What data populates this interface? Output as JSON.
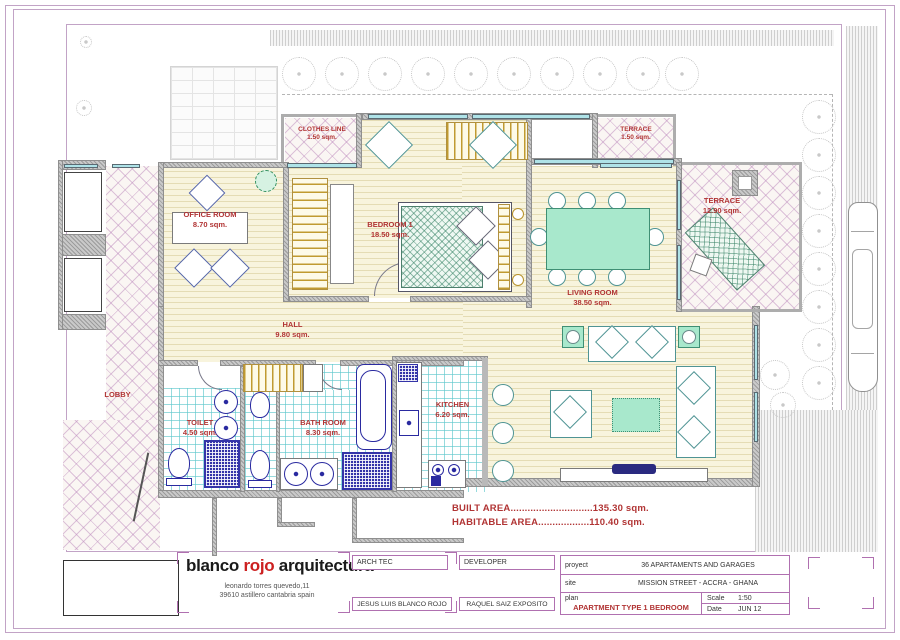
{
  "colors": {
    "accent_red": "#b13434",
    "frame_purple": "#c2a3c6",
    "table_purple": "#b070b0",
    "window_cyan": "#afe3e8",
    "furniture_teal": "#4f9494",
    "fixture_blue": "#2a2aa0",
    "floor_ivory": "#f8f4dd",
    "logo_red": "#cc2020"
  },
  "plan": {
    "rooms": {
      "office": {
        "name": "OFFICE ROOM",
        "area": "8.70 sqm."
      },
      "clothes_line": {
        "name": "CLOTHES LINE",
        "area": "1.50 sqm."
      },
      "bedroom1": {
        "name": "BEDROOM 1",
        "area": "18.50 sqm."
      },
      "terrace_small": {
        "name": "TERRACE",
        "area": "1.50 sqm."
      },
      "terrace_big": {
        "name": "TERRACE",
        "area": "12.90 sqm."
      },
      "living": {
        "name": "LIVING ROOM",
        "area": "38.50 sqm."
      },
      "hall": {
        "name": "HALL",
        "area": "9.80 sqm."
      },
      "lobby": {
        "name": "LOBBY",
        "area": ""
      },
      "toilet": {
        "name": "TOILET",
        "area": "4.50 sqm."
      },
      "bathroom": {
        "name": "BATH ROOM",
        "area": "8.30 sqm."
      },
      "kitchen": {
        "name": "KITCHEN",
        "area": "6.20 sqm."
      }
    },
    "summary": {
      "built_area": "BUILT AREA.............................135.30 sqm.",
      "habitable_area": "HABITABLE AREA..................110.40 sqm."
    }
  },
  "titleblock": {
    "firm_blanco": "blanco",
    "firm_rojo": "rojo",
    "firm_arquitectura": "arquitectura",
    "address_line1": "leonardo torres quevedo,11",
    "address_line2": "39610   astillero   cantabria   spain",
    "arch_label": "ARCH TEC",
    "arch_name": "JESUS LUIS BLANCO ROJO",
    "developer_label": "DEVELOPER",
    "developer_name": "RAQUEL SAIZ EXPOSITO",
    "project_label": "proyect",
    "project_value": "36 APARTAMENTS AND GARAGES",
    "site_label": "site",
    "site_value": "MISSION STREET - ACCRA - GHANA",
    "plan_label": "plan",
    "plan_value": "APARTMENT TYPE 1 BEDROOM",
    "scale_label": "Scale",
    "scale_value": "1:50",
    "date_label": "Date",
    "date_value": "JUN 12"
  }
}
